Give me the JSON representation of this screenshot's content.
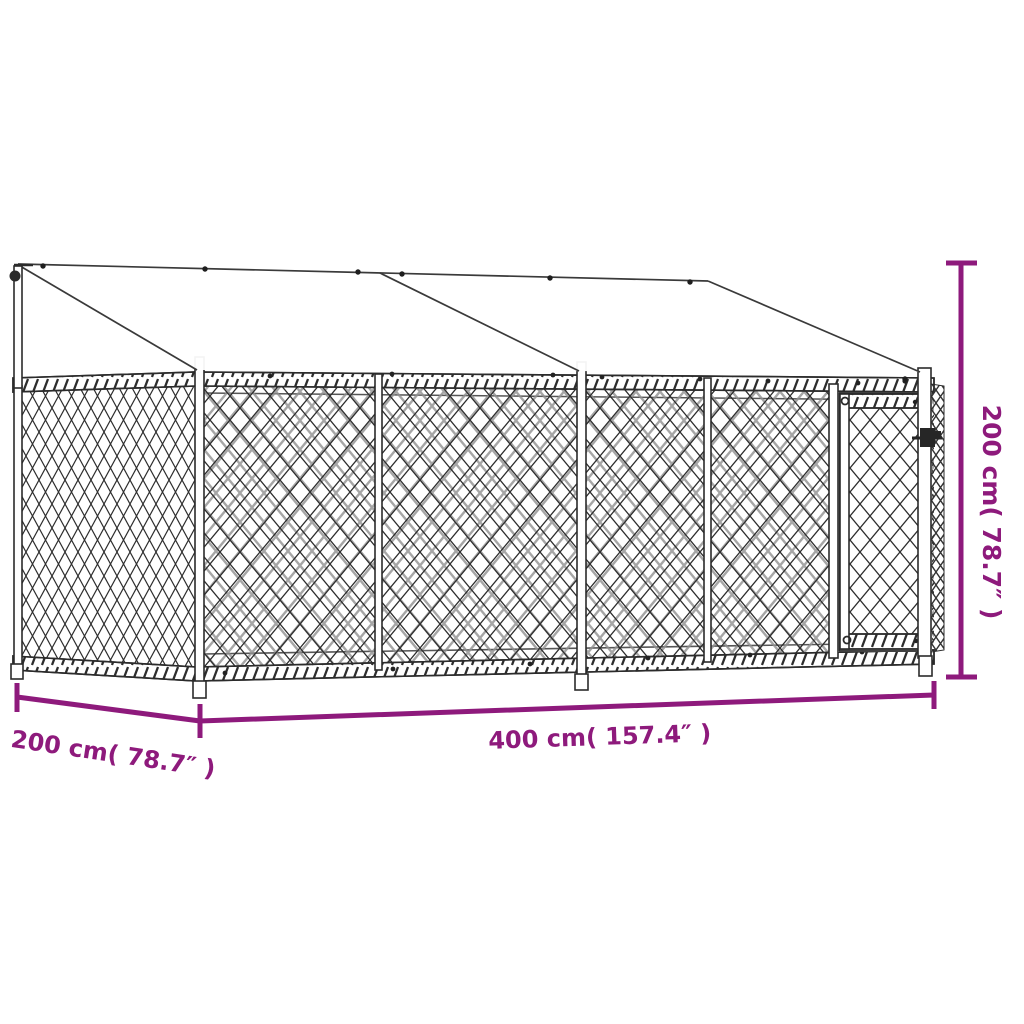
{
  "diagram": {
    "dimensions": {
      "width": {
        "label": "400 cm( 157.4″ )"
      },
      "depth": {
        "label": "200 cm( 78.7″ )"
      },
      "height": {
        "label": "200 cm( 78.7″ )"
      }
    },
    "colors": {
      "dimension_accent": "#8e1a7c",
      "line_art": "#2b2b2b",
      "background": "#ffffff"
    }
  }
}
